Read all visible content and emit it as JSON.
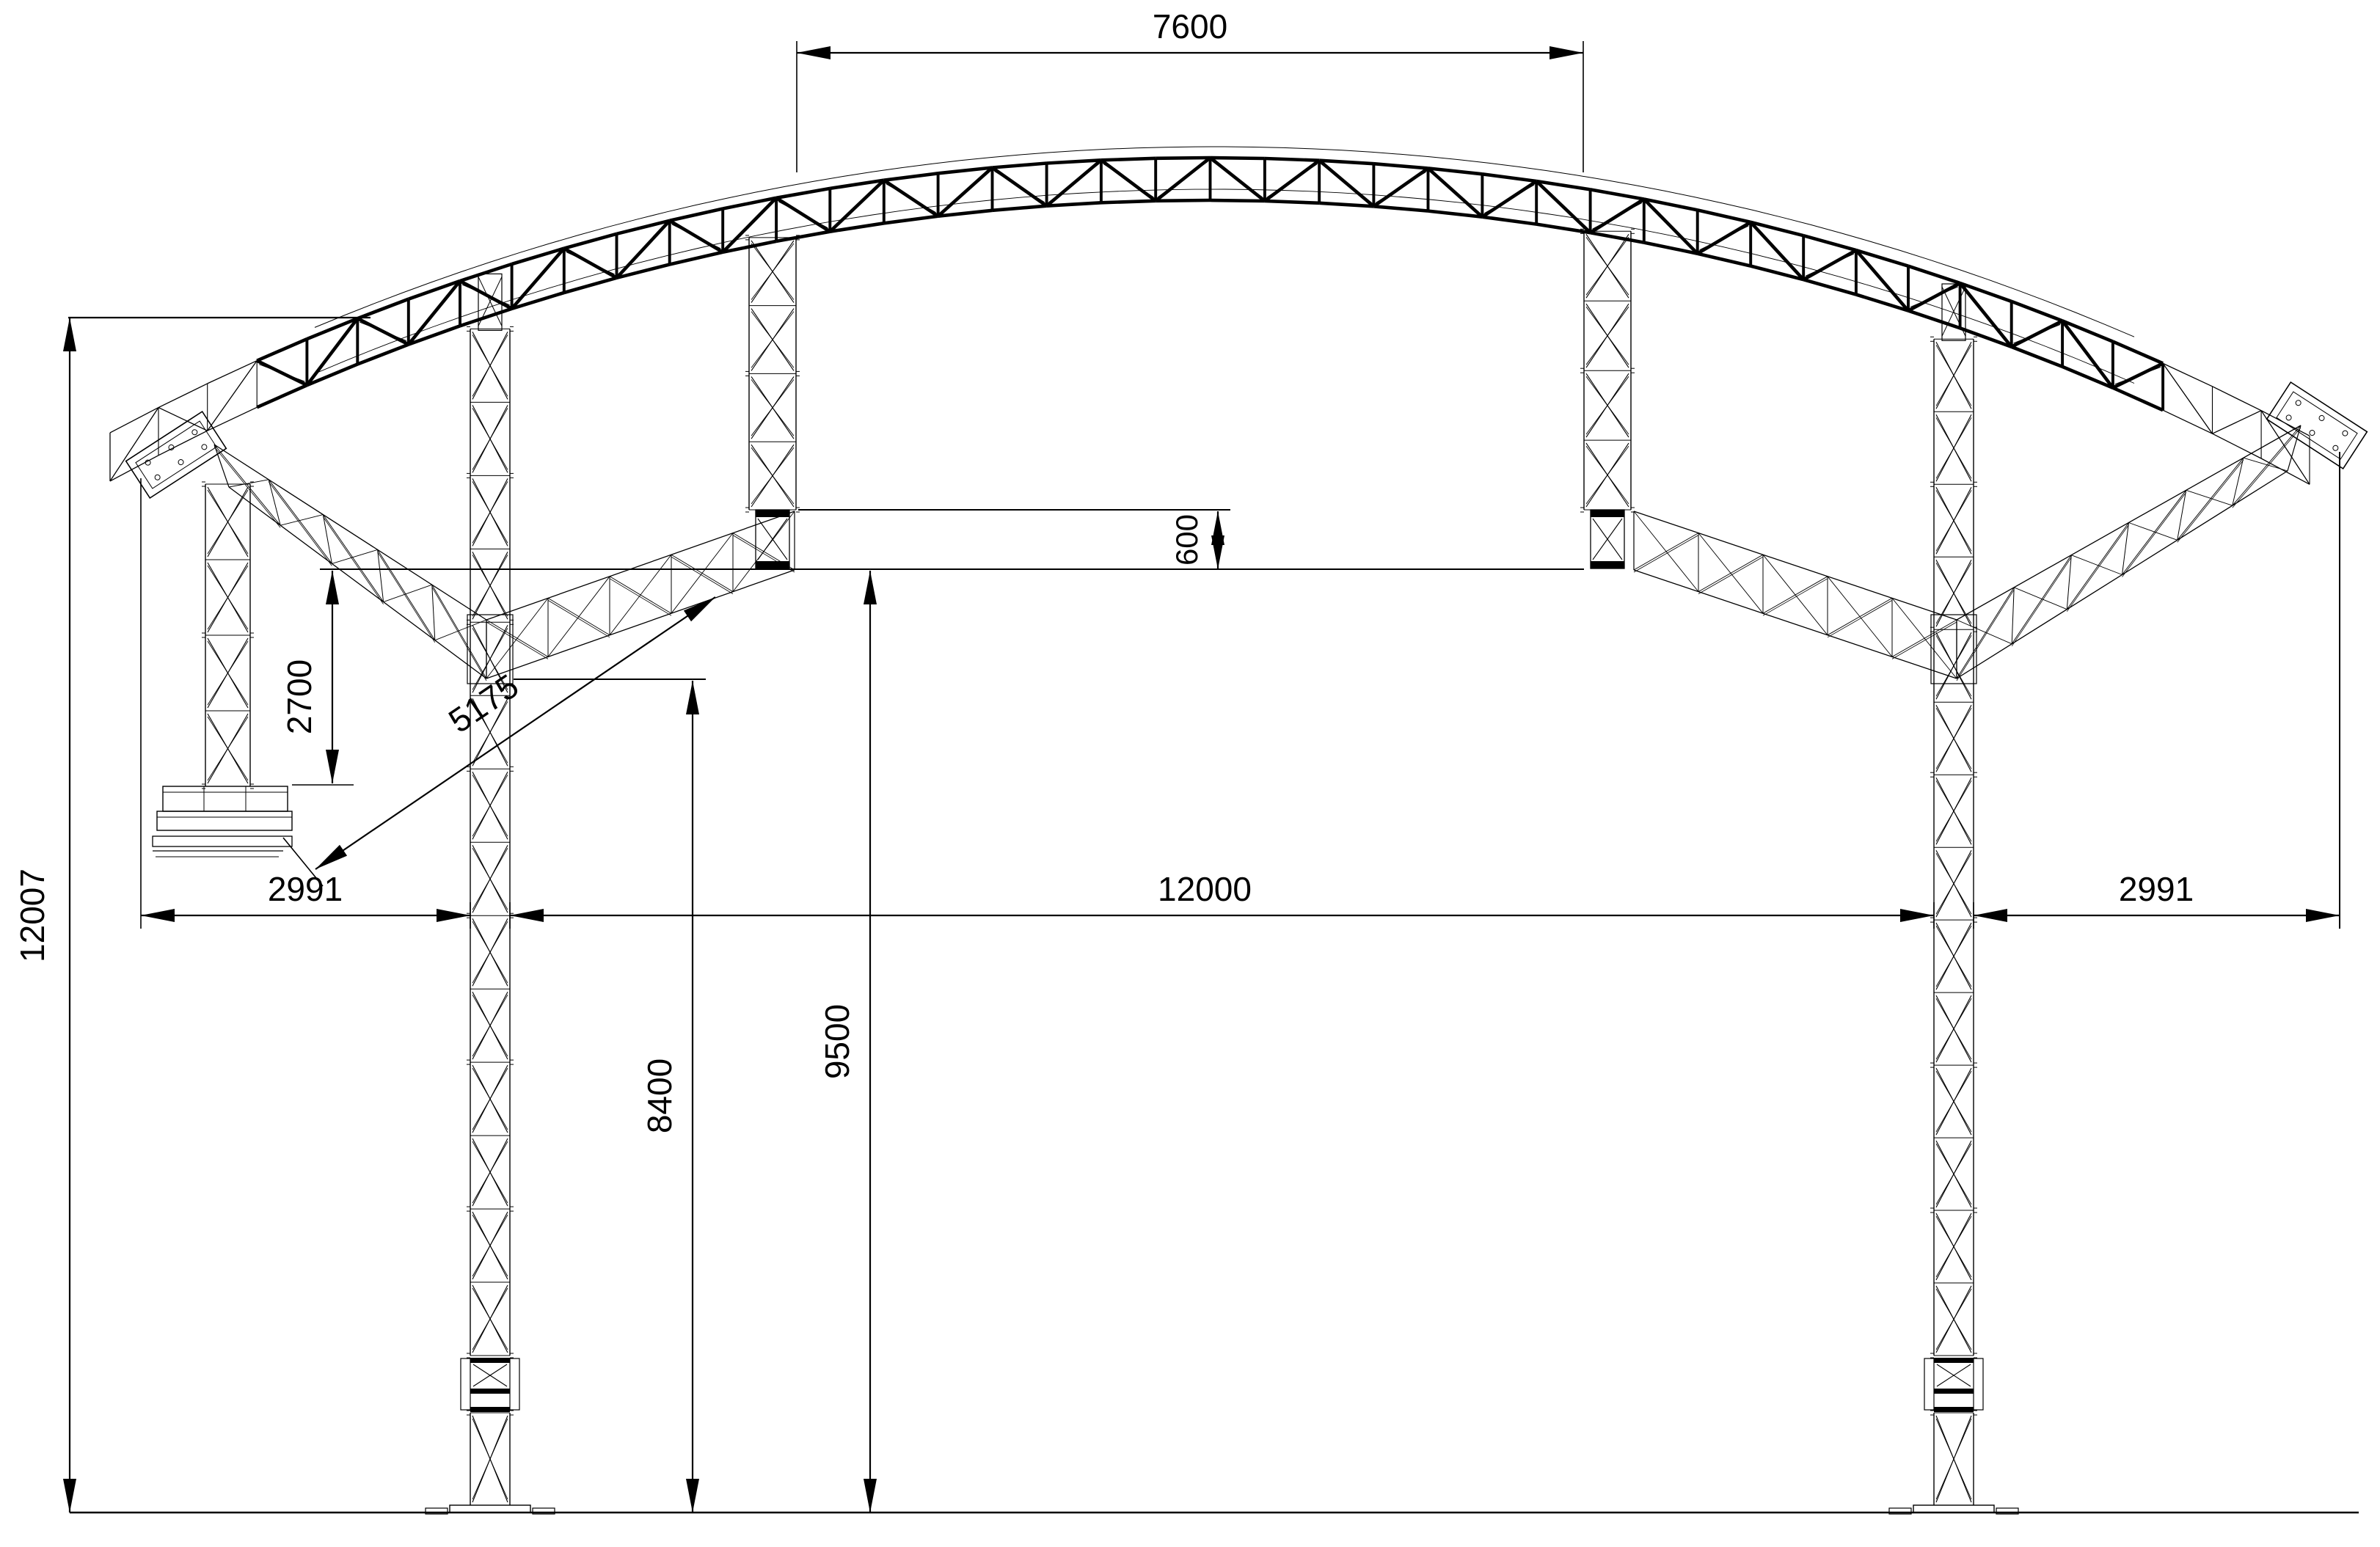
{
  "drawing": {
    "background": "#ffffff",
    "ink": "#000000",
    "view": "front-elevation"
  },
  "dimensions": {
    "top_span": {
      "label": "7600",
      "unit": "mm",
      "orientation": "horizontal",
      "about": "clear span between inner hanging towers"
    },
    "overall_height": {
      "label": "12007",
      "unit": "mm",
      "orientation": "vertical",
      "about": "overall height from ground to arch end top chord"
    },
    "left_offset": {
      "label": "2991",
      "unit": "mm",
      "orientation": "horizontal",
      "about": "left wing tip to left main tower"
    },
    "main_span": {
      "label": "12000",
      "unit": "mm",
      "orientation": "horizontal",
      "about": "clear span between main towers"
    },
    "right_offset": {
      "label": "2991",
      "unit": "mm",
      "orientation": "horizontal",
      "about": "right main tower to right wing tip"
    },
    "truss_step": {
      "label": "600",
      "unit": "mm",
      "orientation": "vertical",
      "about": "depth step between wing truss chords"
    },
    "outrigger_drop": {
      "label": "2700",
      "unit": "mm",
      "orientation": "vertical",
      "about": "wing chord level down to ballast base"
    },
    "brace_length": {
      "label": "5175",
      "unit": "mm",
      "orientation": "aligned",
      "about": "diagonal from ballast base to wing spur"
    },
    "clearance_left": {
      "label": "8400",
      "unit": "mm",
      "orientation": "vertical",
      "about": "ground to wing knee underside"
    },
    "clearance_mid": {
      "label": "9500",
      "unit": "mm",
      "orientation": "vertical",
      "about": "ground to wing spur bottom chord"
    }
  },
  "components": {
    "arch": "curved lattice roof truss",
    "left_main_tower": "ground support tower with sleeve block",
    "right_main_tower": "ground support tower with sleeve block",
    "left_inner_tower": "hanging lattice tower",
    "right_inner_tower": "hanging lattice tower",
    "left_outer_tower": "outrigger tower on ballast base",
    "ballast_base": "stacked ballast plates",
    "left_wing": "lattice wing truss",
    "right_wing": "lattice wing truss",
    "ground": "ground reference line"
  }
}
